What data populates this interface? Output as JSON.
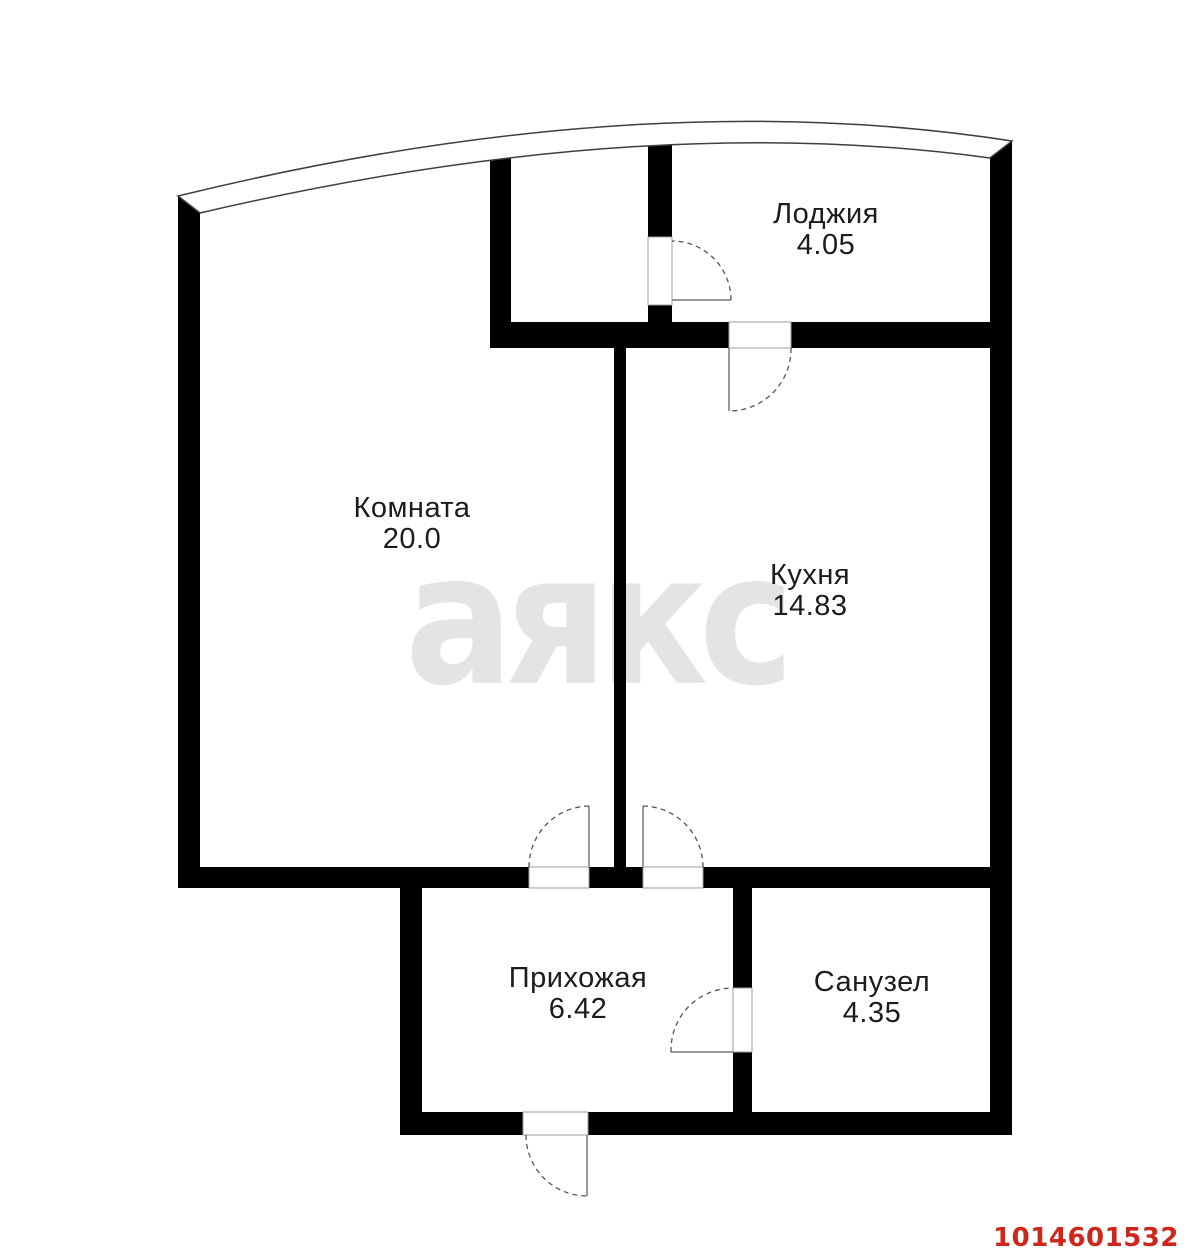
{
  "watermark": "аякс",
  "listing_id": "1014601532",
  "colors": {
    "wall": "#000000",
    "background": "#ffffff",
    "watermark": "#e4e4e4",
    "listing_id_red": "#cf261b"
  },
  "rooms": [
    {
      "key": "loggia",
      "name": "Лоджия",
      "area": "4.05"
    },
    {
      "key": "room",
      "name": "Комната",
      "area": "20.0"
    },
    {
      "key": "kitchen",
      "name": "Кухня",
      "area": "14.83"
    },
    {
      "key": "hallway",
      "name": "Прихожая",
      "area": "6.42"
    },
    {
      "key": "bathroom",
      "name": "Санузел",
      "area": "4.35"
    }
  ]
}
